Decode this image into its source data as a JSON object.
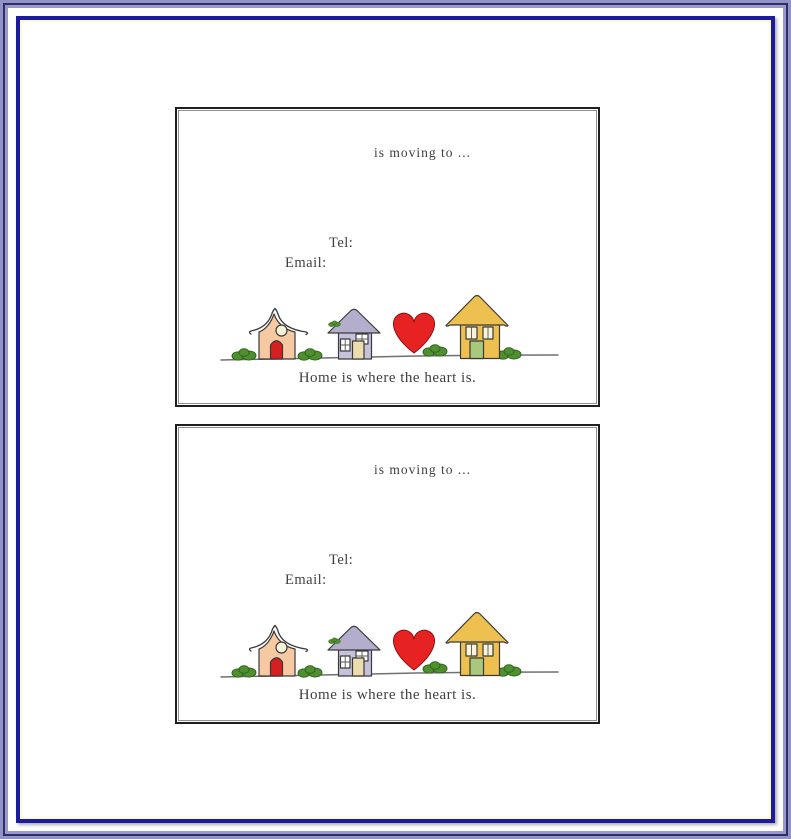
{
  "frame": {
    "outer_lavender": "#9292c4",
    "outer_dark_navy": "#2e2e68",
    "inner_navy": "#1b1b9b",
    "inner_cream": "#fcf9d6",
    "card_border": "#1f1f1f"
  },
  "cards": [
    {
      "moving_text": "is moving to ...",
      "tel_label": "Tel:",
      "email_label": "Email:",
      "footer_text": "Home is where the heart is."
    },
    {
      "moving_text": "is moving to ...",
      "tel_label": "Tel:",
      "email_label": "Email:",
      "footer_text": "Home is where the heart is."
    }
  ],
  "illustration": {
    "house_left_color": "#f6c9a2",
    "house_left_window_color": "#f8f1d9",
    "house_left_door_color": "#d42020",
    "house_middle_roof_color": "#b3aecb",
    "house_middle_color": "#c6c2dc",
    "house_middle_window_color": "#ffffff",
    "house_middle_door_color": "#ecdcae",
    "house_right_color": "#edc04f",
    "house_right_window_color": "#faf3dc",
    "house_right_door_color": "#a9c87d",
    "heart_color": "#e62222",
    "bush_color": "#4e8f2f",
    "ground_line_color": "#707070"
  }
}
